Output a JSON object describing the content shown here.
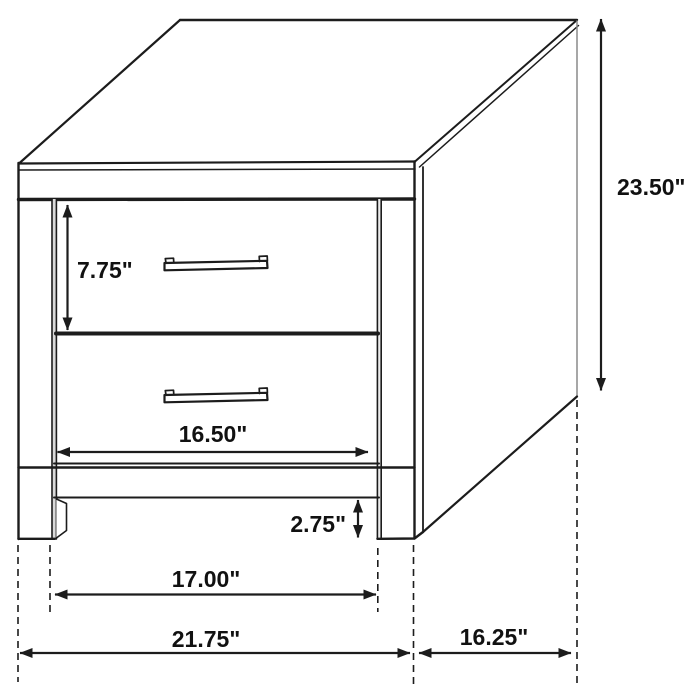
{
  "diagram": {
    "background": "#ffffff",
    "line_color": "#1c1c1c",
    "edge_gray": "#8a8a8a",
    "label_color": "#111111",
    "labels": {
      "drawer_height": "7.75\"",
      "overall_height": "23.50\"",
      "drawer_width": "16.50\"",
      "leg_clearance": "2.75\"",
      "between_legs": "17.00\"",
      "overall_width": "21.75\"",
      "depth": "16.25\""
    }
  }
}
